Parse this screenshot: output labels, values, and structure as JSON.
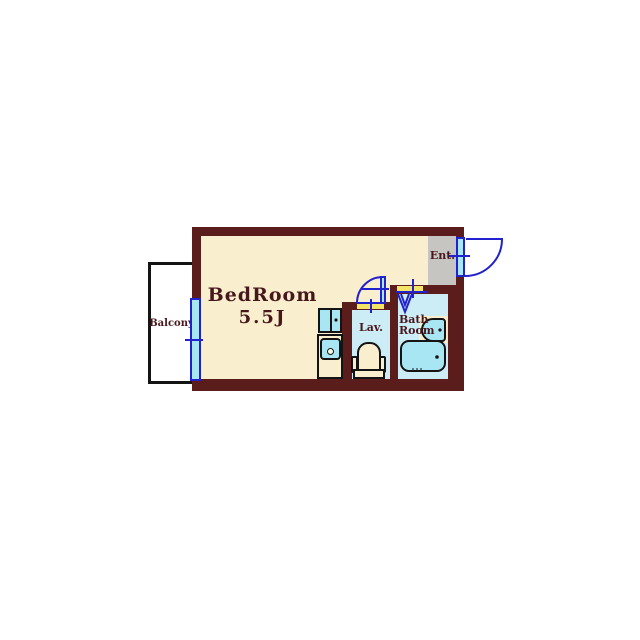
{
  "floorplan": {
    "rooms": {
      "bedroom": {
        "name": "BedRoom",
        "size": "5.5J"
      },
      "balcony": {
        "name": "Balcony"
      },
      "entrance": {
        "name": "Ent."
      },
      "lavatory": {
        "name": "Lav."
      },
      "bathroom": {
        "name_line1": "Bath",
        "name_line2": "Room"
      }
    },
    "colors": {
      "wall": "#5b1d1b",
      "bedroom_floor": "#f9efcf",
      "wet_floor": "#cdedf6",
      "fixture": "#a8e6f4",
      "entrance_floor": "#c7c5c1",
      "threshold": "#f3e468",
      "opening_blue": "#2121cd",
      "outline": "#141414",
      "label_text": "#47171c"
    }
  }
}
